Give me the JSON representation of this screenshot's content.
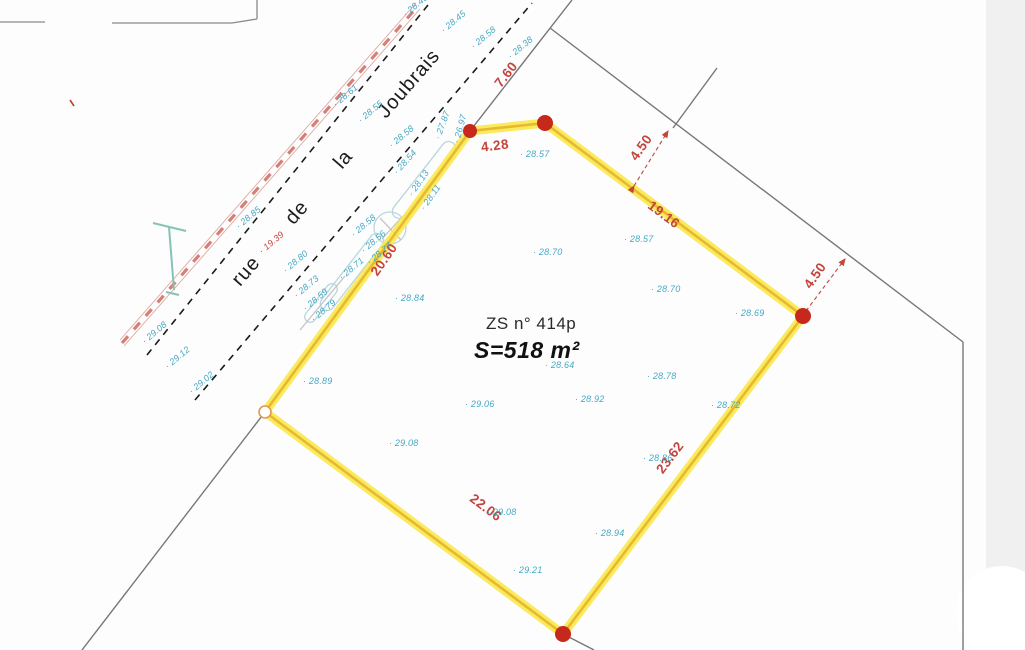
{
  "street": {
    "name": "rue de la Joubrais"
  },
  "parcel": {
    "zone_label": "ZS n° 414p",
    "area_label": "S=518 m²"
  },
  "dimensions": [
    {
      "label": "4.28",
      "x": 481,
      "y": 138,
      "r": -7
    },
    {
      "label": "7.60",
      "x": 492,
      "y": 67,
      "r": -52
    },
    {
      "label": "4.50",
      "x": 627,
      "y": 140,
      "r": -55
    },
    {
      "label": "19.16",
      "x": 646,
      "y": 207,
      "r": 37
    },
    {
      "label": "4.50",
      "x": 801,
      "y": 268,
      "r": -55
    },
    {
      "label": "20.60",
      "x": 366,
      "y": 252,
      "r": -55
    },
    {
      "label": "22.06",
      "x": 468,
      "y": 500,
      "r": 37
    },
    {
      "label": "23.62",
      "x": 652,
      "y": 450,
      "r": -53
    }
  ],
  "spot_levels": [
    {
      "v": "28.40",
      "x": 404,
      "y": 10,
      "r": -40
    },
    {
      "v": "28.45",
      "x": 442,
      "y": 26,
      "r": -40
    },
    {
      "v": "28.58",
      "x": 472,
      "y": 42,
      "r": -40
    },
    {
      "v": "28.38",
      "x": 509,
      "y": 52,
      "r": -40
    },
    {
      "v": "28.61",
      "x": 334,
      "y": 100,
      "r": -40
    },
    {
      "v": "28.55",
      "x": 359,
      "y": 116,
      "r": -40
    },
    {
      "v": "28.58",
      "x": 390,
      "y": 141,
      "r": -40
    },
    {
      "v": "28.85",
      "x": 237,
      "y": 222,
      "r": -40
    },
    {
      "v": "28.80",
      "x": 284,
      "y": 266,
      "r": -40
    },
    {
      "v": "19.39",
      "x": 260,
      "y": 247,
      "r": -40,
      "red": true
    },
    {
      "v": "29.08",
      "x": 143,
      "y": 337,
      "r": -40
    },
    {
      "v": "29.12",
      "x": 166,
      "y": 362,
      "r": -40
    },
    {
      "v": "29.02",
      "x": 190,
      "y": 387,
      "r": -40
    },
    {
      "v": "28.73",
      "x": 295,
      "y": 291,
      "r": -40
    },
    {
      "v": "28.59",
      "x": 304,
      "y": 304,
      "r": -40
    },
    {
      "v": "28.79",
      "x": 312,
      "y": 315,
      "r": -40
    },
    {
      "v": "27.87",
      "x": 437,
      "y": 134,
      "r": -70
    },
    {
      "v": "26.97",
      "x": 456,
      "y": 138,
      "r": -75
    },
    {
      "v": "28.54",
      "x": 395,
      "y": 168,
      "r": -48
    },
    {
      "v": "28.13",
      "x": 410,
      "y": 190,
      "r": -55
    },
    {
      "v": "28.11",
      "x": 422,
      "y": 204,
      "r": -55
    },
    {
      "v": "28.58",
      "x": 352,
      "y": 230,
      "r": -40
    },
    {
      "v": "28.56",
      "x": 362,
      "y": 246,
      "r": -40
    },
    {
      "v": "28.77",
      "x": 368,
      "y": 258,
      "r": -40
    },
    {
      "v": "28.71",
      "x": 340,
      "y": 273,
      "r": -40
    },
    {
      "v": "28.57",
      "x": 520,
      "y": 149,
      "r": 0
    },
    {
      "v": "28.70",
      "x": 533,
      "y": 247,
      "r": 0
    },
    {
      "v": "28.57",
      "x": 624,
      "y": 234,
      "r": 0
    },
    {
      "v": "28.70",
      "x": 651,
      "y": 284,
      "r": 0
    },
    {
      "v": "28.69",
      "x": 735,
      "y": 308,
      "r": 0
    },
    {
      "v": "28.84",
      "x": 395,
      "y": 293,
      "r": 0
    },
    {
      "v": "28.89",
      "x": 303,
      "y": 376,
      "r": 0
    },
    {
      "v": "28.64",
      "x": 545,
      "y": 360,
      "r": 0
    },
    {
      "v": "28.78",
      "x": 647,
      "y": 371,
      "r": 0
    },
    {
      "v": "28.92",
      "x": 575,
      "y": 394,
      "r": 0
    },
    {
      "v": "28.72",
      "x": 711,
      "y": 400,
      "r": 0
    },
    {
      "v": "29.06",
      "x": 465,
      "y": 399,
      "r": 0
    },
    {
      "v": "29.08",
      "x": 389,
      "y": 438,
      "r": 0
    },
    {
      "v": "29.08",
      "x": 487,
      "y": 507,
      "r": 0
    },
    {
      "v": "29.21",
      "x": 513,
      "y": 565,
      "r": 0
    },
    {
      "v": "28.86",
      "x": 643,
      "y": 453,
      "r": 0
    },
    {
      "v": "28.94",
      "x": 595,
      "y": 528,
      "r": 0
    }
  ],
  "colors": {
    "parcel_outline": "#F5DF2E",
    "parcel_outline_core": "#E8B92F",
    "vertex_dot": "#C6281C",
    "dimension_text": "#C4443C",
    "spot_level_text": "#45A9C5",
    "street_dashed_line": "#1A1A1A",
    "fence_line": "#C9564B",
    "boundary_line": "#777777",
    "utility_symbol": "#86C3B6",
    "curb_outline": "#B9D6DD"
  }
}
